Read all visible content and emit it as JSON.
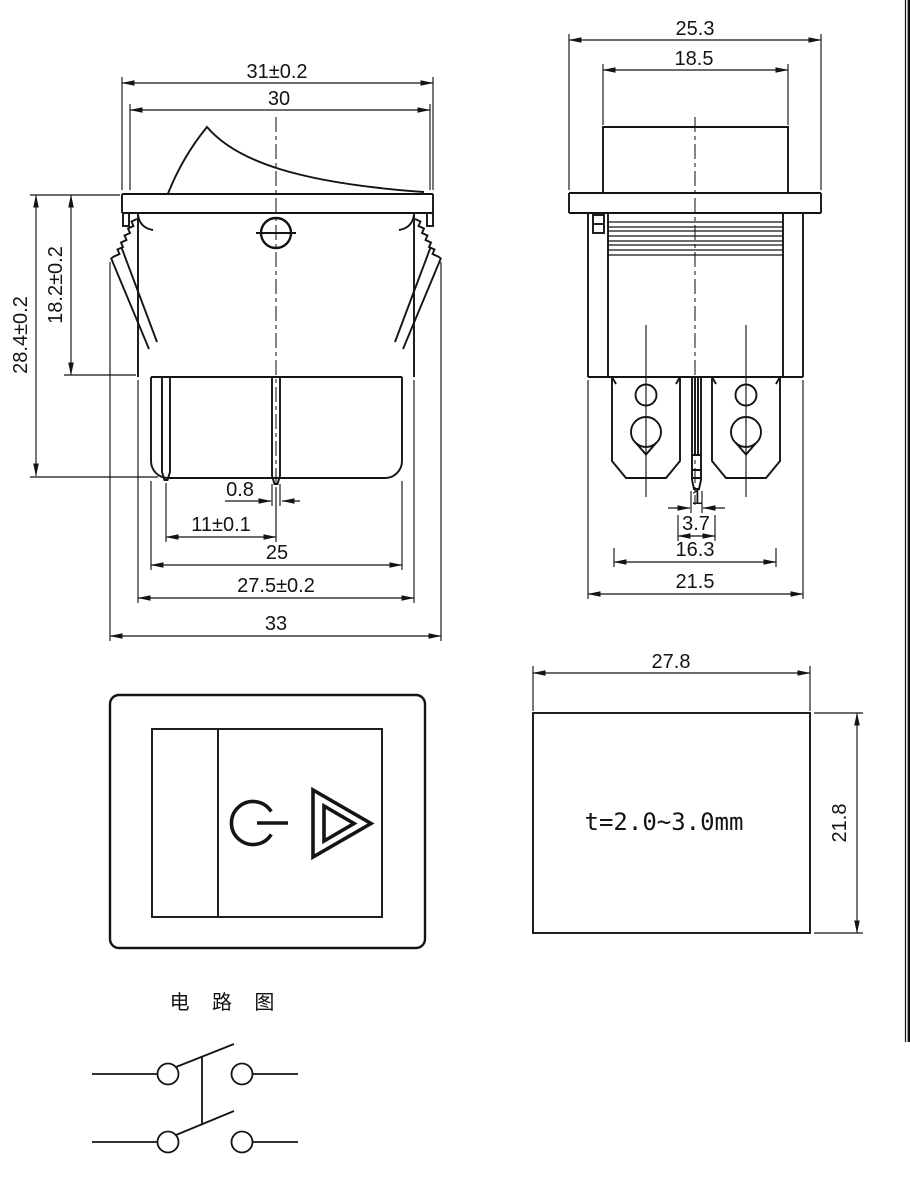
{
  "document_type": "rocker-switch-technical-drawing",
  "colors": {
    "line": "#141414",
    "background": "#ffffff"
  },
  "views": {
    "front": {
      "dims": {
        "flange_width": "31±0.2",
        "opening_width": "30",
        "total_height": "28.4±0.2",
        "body_height": "18.2±0.2",
        "terminal_thickness": "0.8",
        "terminal_pitch": "11±0.1",
        "housing_width": "25",
        "body_width": "27.5±0.2",
        "overall_width": "33"
      }
    },
    "side": {
      "dims": {
        "flange_width": "25.3",
        "actuator_width": "18.5",
        "center_terminal_thickness": "1",
        "slot_width": "3.7",
        "terminal_span": "16.3",
        "body_width": "21.5"
      }
    },
    "cutout": {
      "panel_thickness_label": "t=2.0~3.0mm",
      "dims": {
        "width": "27.8",
        "height": "21.8"
      }
    },
    "circuit": {
      "title": "电 路 图"
    }
  }
}
